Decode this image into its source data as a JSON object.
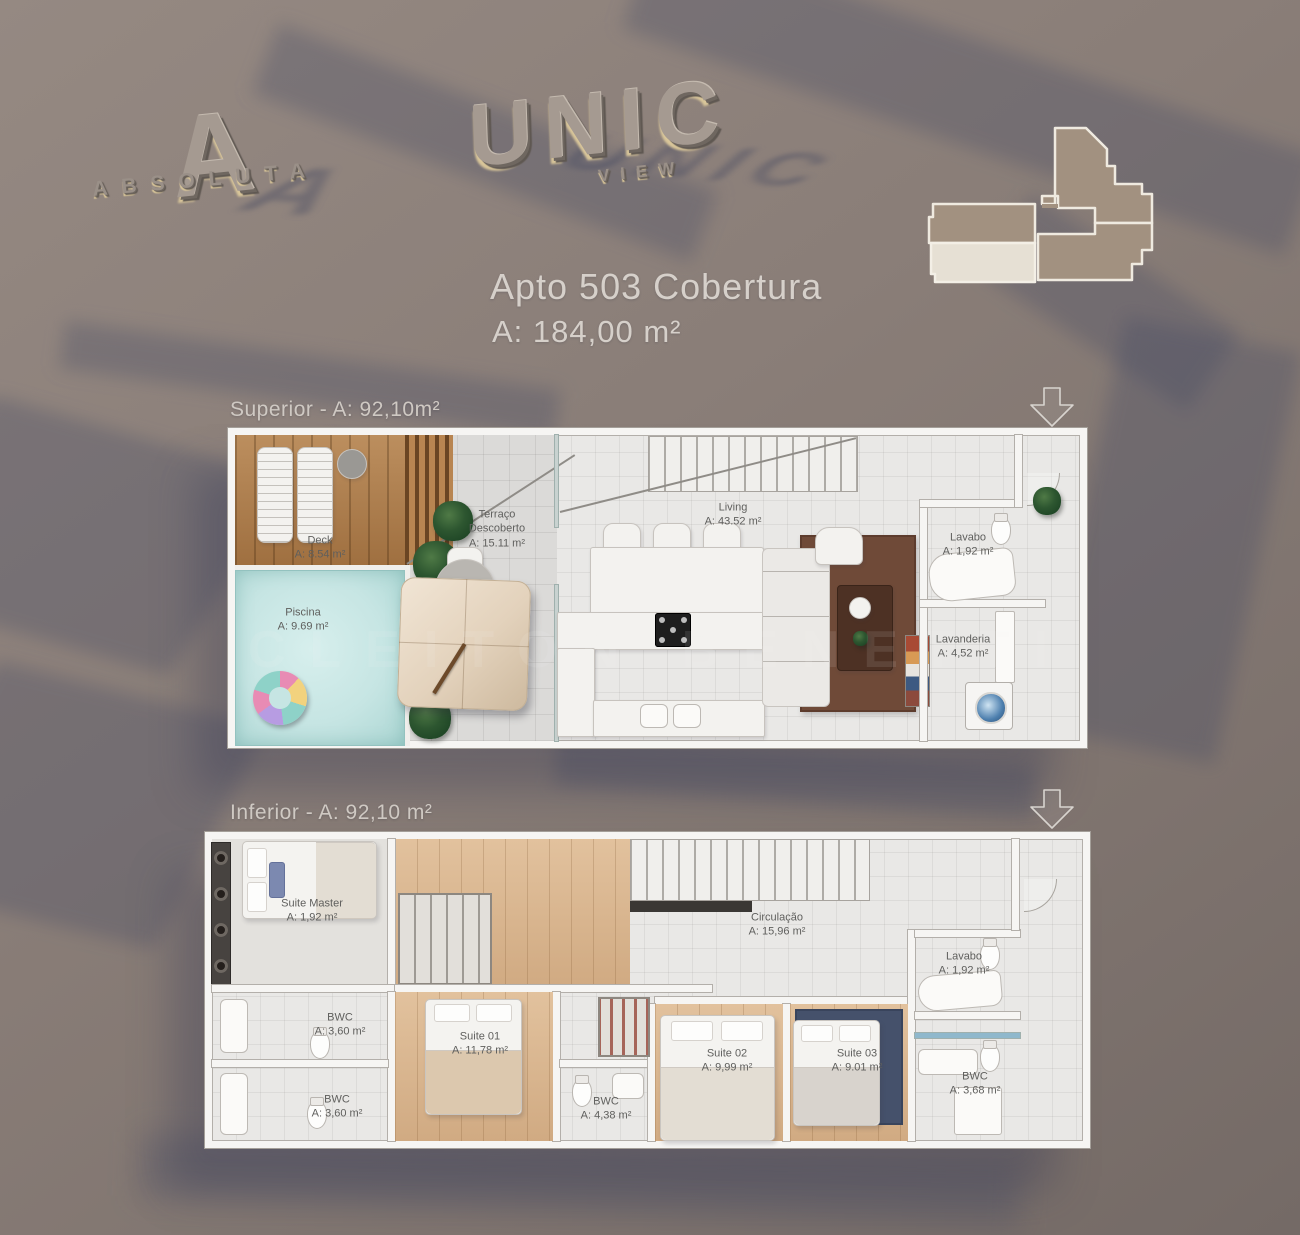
{
  "brand": {
    "absoluta_monogram": "A",
    "absoluta_name": "ABSOLUTA",
    "unic_name": "UNIC",
    "unic_sub": "VIEW"
  },
  "title": {
    "line1": "Apto 503 Cobertura",
    "line2": "A: 184,00 m²"
  },
  "watermark": "CLEITON BENETTI",
  "floors": {
    "superior": {
      "label": "Superior - A: 92,10m²",
      "rooms": {
        "deck": {
          "name": "Deck",
          "area": "A: 8.54 m²"
        },
        "piscina": {
          "name": "Piscina",
          "area": "A: 9.69 m²"
        },
        "terraco": {
          "name": "Terraço Descoberto",
          "area": "A: 15.11 m²"
        },
        "living": {
          "name": "Living",
          "area": "A: 43.52 m²"
        },
        "lavabo": {
          "name": "Lavabo",
          "area": "A: 1,92 m²"
        },
        "lavanderia": {
          "name": "Lavanderia",
          "area": "A: 4,52 m²"
        }
      }
    },
    "inferior": {
      "label": "Inferior - A: 92,10 m²",
      "rooms": {
        "suite_master": {
          "name": "Suite Master",
          "area": "A: 1,92 m²"
        },
        "circulacao": {
          "name": "Circulação",
          "area": "A: 15,96 m²"
        },
        "bwc_top_left": {
          "name": "BWC",
          "area": "A: 3,60 m²"
        },
        "bwc_bottom_left": {
          "name": "BWC",
          "area": "A: 3,60 m²"
        },
        "suite_01": {
          "name": "Suite 01",
          "area": "A: 11,78 m²"
        },
        "bwc_middle": {
          "name": "BWC",
          "area": "A: 4,38 m²"
        },
        "suite_02": {
          "name": "Suite 02",
          "area": "A: 9,99 m²"
        },
        "suite_03": {
          "name": "Suite 03",
          "area": "A: 9.01 m²"
        },
        "lavabo": {
          "name": "Lavabo",
          "area": "A: 1,92 m²"
        },
        "bwc_right": {
          "name": "BWC",
          "area": "A: 3,68 m²"
        }
      }
    }
  },
  "colors": {
    "background": "#8a7e78",
    "cast_shadow": "#424862",
    "wall": "#f6f5f3",
    "floor_tile": "#e9e8e6",
    "deck_wood": "#ad7b49",
    "pool_water": "#c6e5e3",
    "living_rug": "#6f4a38",
    "suite03_rug": "#45516b",
    "suite_wood": "#d8b28a",
    "keyplan_unit_highlight": "#e6e0d4",
    "keyplan_building": "#a29180"
  }
}
